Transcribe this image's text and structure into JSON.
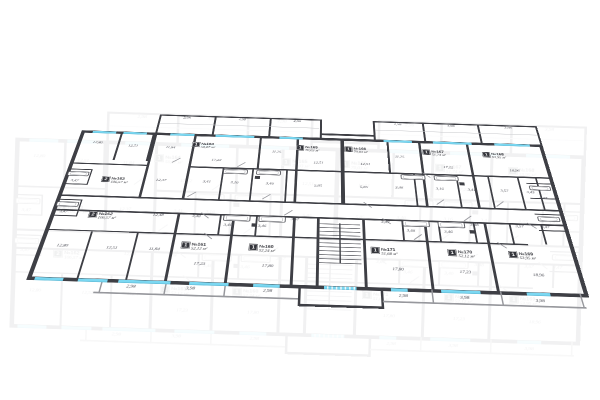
{
  "colors": {
    "wall": "#3e3f45",
    "window": "#7bd8f2",
    "badge": "#35363c",
    "dim": "#4b4c55",
    "text": "#2f3036"
  },
  "floor_plan": {
    "units_suffix": "м²"
  },
  "apartments": [
    {
      "number": "№163",
      "rooms": "2",
      "area": "106,57 м²"
    },
    {
      "number": "№162",
      "rooms": "2",
      "area": "106,57 м²"
    },
    {
      "number": "№164",
      "rooms": "1",
      "area": "50,67 м²"
    },
    {
      "number": "№165",
      "rooms": "1",
      "area": "70,03 м²"
    },
    {
      "number": "№166",
      "rooms": "1",
      "area": "70,03 м²"
    },
    {
      "number": "№167",
      "rooms": "1",
      "area": "51,74 м²"
    },
    {
      "number": "№168",
      "rooms": "1",
      "area": "53,95 м²"
    },
    {
      "number": "№161",
      "rooms": "1",
      "area": "52,12 м²"
    },
    {
      "number": "№160",
      "rooms": "1",
      "area": "52,24 м²"
    },
    {
      "number": "№171",
      "rooms": "1",
      "area": "51,68 м²"
    },
    {
      "number": "№170",
      "rooms": "1",
      "area": "52,12 м²"
    },
    {
      "number": "№169",
      "rooms": "1",
      "area": "53,95 м²"
    }
  ],
  "dims": [
    "2,98",
    "3,98",
    "2,98",
    "2,98",
    "3,98",
    "3,98",
    "12,80",
    "12,51",
    "11,84",
    "11,25",
    "12,51",
    "12,51",
    "11,25",
    "17,22",
    "17,22",
    "18,96",
    "12,37",
    "3,41",
    "3,16",
    "3,46",
    "5,85",
    "5,85",
    "3,46",
    "3,16",
    "3,41",
    "3,57",
    "3,43",
    "3,47",
    "3,47",
    "3,47",
    "12,48",
    "3,48",
    "3,46",
    "3,46",
    "3,67",
    "3,67",
    "3,46",
    "3,46",
    "3,48",
    "3,57",
    "3,47",
    "12,80",
    "12,51",
    "11,84",
    "17,23",
    "17,80",
    "17,80",
    "17,23",
    "18,96",
    "2,98",
    "3,98",
    "2,98",
    "2,98",
    "3,98",
    "3,98"
  ]
}
